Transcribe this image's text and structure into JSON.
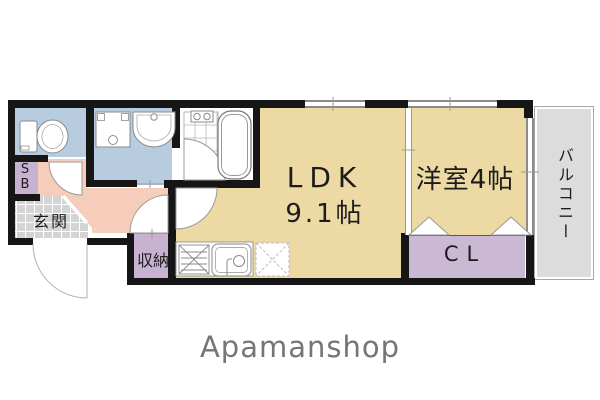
{
  "brand": {
    "logo_text": "Apamanshop",
    "color": "#757575"
  },
  "floorplan": {
    "rooms": {
      "ldk": {
        "name_label": "LDK",
        "size_label": "9.1帖"
      },
      "western_room": {
        "label": "洋室4帖"
      },
      "balcony": {
        "label": "バルコニー"
      },
      "closet": {
        "label": "CL"
      },
      "storage": {
        "label": "収納"
      },
      "entrance": {
        "label": "玄関"
      },
      "shoe_box": {
        "line1": "S",
        "line2": "B"
      }
    },
    "colors": {
      "room_tan": "#ecd9a3",
      "wet_area_blue": "#b7cddf",
      "storage_purple": "#c7b2d1",
      "hallway_pink": "#f6cdbb",
      "entrance_gray": "#d4d4d4",
      "balcony_gray": "#dcdcdc",
      "wall_black": "#161616"
    },
    "fixtures": [
      "toilet-icon",
      "washing-machine-pan-icon",
      "vanity-sink-icon",
      "bathtub-icon",
      "shower-tile-floor",
      "kitchen-stove-icon",
      "kitchen-sink-icon",
      "refrigerator-space-icon",
      "folding-closet-door-icon",
      "swing-door-arc",
      "entrance-door-arc"
    ]
  }
}
